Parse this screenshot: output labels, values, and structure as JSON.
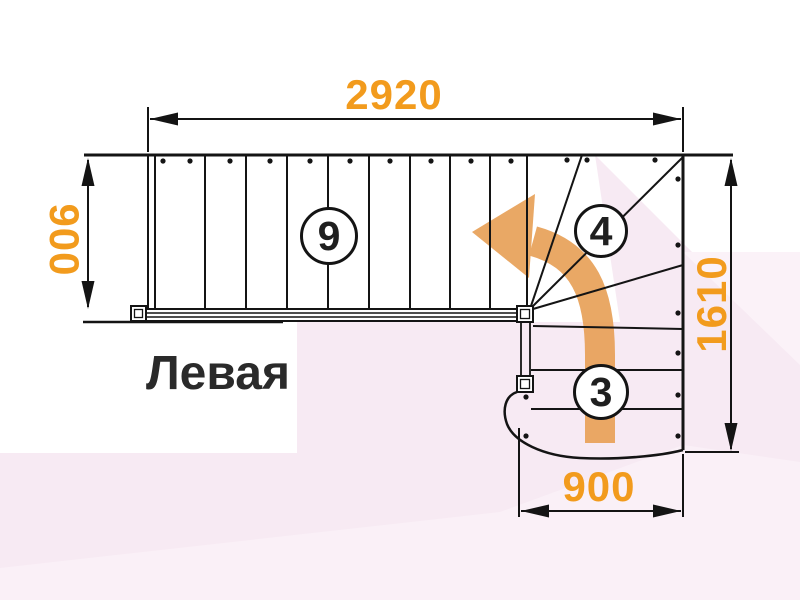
{
  "title": "Левая",
  "dimensions": {
    "top_width": "2920",
    "left_depth": "900",
    "right_total": "1610",
    "bottom_width": "900"
  },
  "steps": {
    "upper_flight": "9",
    "winder": "4",
    "lower_flight": "3"
  },
  "colors": {
    "dimension_text": "#f29b1d",
    "direction_arrow": "#e8a158",
    "drawing_line": "#141414",
    "background_pink": "#f7eaf3",
    "title_text": "#2a2a2a"
  }
}
